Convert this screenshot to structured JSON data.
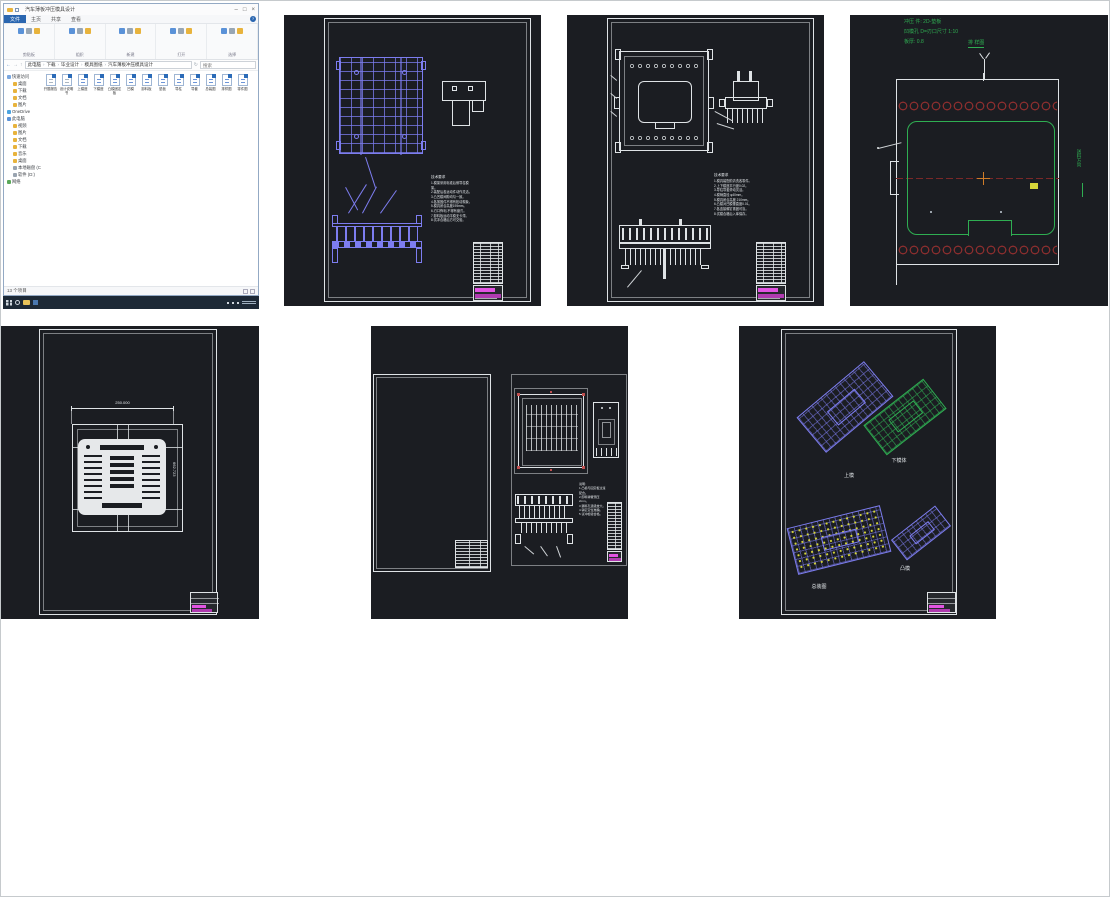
{
  "colors": {
    "cad_background": "#1b1d22",
    "cad_white": "#dfe3e6",
    "cad_purple": "#7d7df0",
    "cad_green": "#2fae52",
    "cad_red": "#8c2e2e",
    "cad_magenta": "#e254e2",
    "cad_yellow": "#d6d63a",
    "cad_orange": "#cf7c28",
    "taskbar_dark": "#1d2936",
    "file_tab_blue": "#2a66b0"
  },
  "explorer": {
    "title": "汽车薄板冲压模具设计",
    "window_controls": {
      "min": "–",
      "max": "□",
      "close": "×"
    },
    "file_tab": "文件",
    "tabs": [
      "主页",
      "共享",
      "查看"
    ],
    "help": "?",
    "groups": [
      {
        "label": "剪贴板"
      },
      {
        "label": "组织"
      },
      {
        "label": "新建"
      },
      {
        "label": "打开"
      },
      {
        "label": "选择"
      }
    ],
    "breadcrumb": [
      "此电脑",
      "下载",
      "毕业设计",
      "模具图纸",
      "汽车薄板冲压模具设计"
    ],
    "search_placeholder": "搜索",
    "nav": [
      {
        "label": "快速访问",
        "indent": 0,
        "icon": "star"
      },
      {
        "label": "桌面",
        "indent": 1,
        "icon": "folder"
      },
      {
        "label": "下载",
        "indent": 1,
        "icon": "folder"
      },
      {
        "label": "文档",
        "indent": 1,
        "icon": "folder"
      },
      {
        "label": "图片",
        "indent": 1,
        "icon": "folder"
      },
      {
        "label": "OneDrive",
        "indent": 0,
        "icon": "cloud"
      },
      {
        "label": "此电脑",
        "indent": 0,
        "icon": "pc"
      },
      {
        "label": "视频",
        "indent": 1,
        "icon": "folder"
      },
      {
        "label": "图片",
        "indent": 1,
        "icon": "folder"
      },
      {
        "label": "文档",
        "indent": 1,
        "icon": "folder"
      },
      {
        "label": "下载",
        "indent": 1,
        "icon": "folder"
      },
      {
        "label": "音乐",
        "indent": 1,
        "icon": "folder"
      },
      {
        "label": "桌面",
        "indent": 1,
        "icon": "folder"
      },
      {
        "label": "本地磁盘 (C:)",
        "indent": 1,
        "icon": "disk"
      },
      {
        "label": "软件 (D:)",
        "indent": 1,
        "icon": "disk"
      },
      {
        "label": "网络",
        "indent": 0,
        "icon": "net"
      }
    ],
    "files": [
      {
        "name": "开题报告",
        "kind": "doc"
      },
      {
        "name": "设计说明书",
        "kind": "doc"
      },
      {
        "name": "上模座",
        "kind": "dwg"
      },
      {
        "name": "下模座",
        "kind": "dwg"
      },
      {
        "name": "凸模固定板",
        "kind": "dwg"
      },
      {
        "name": "凹模",
        "kind": "dwg"
      },
      {
        "name": "卸料板",
        "kind": "dwg"
      },
      {
        "name": "垫板",
        "kind": "dwg"
      },
      {
        "name": "导柱",
        "kind": "dwg"
      },
      {
        "name": "导套",
        "kind": "dwg"
      },
      {
        "name": "总装图",
        "kind": "dwg"
      },
      {
        "name": "排样图",
        "kind": "dwg"
      },
      {
        "name": "零件图",
        "kind": "dwg"
      }
    ],
    "status": "13 个项目"
  },
  "drawings": {
    "sheet_a": {
      "notes_title": "技术要求",
      "notes": [
        "1.模架采用标准后侧导柱模架。",
        "2.装配后各运动件动作灵活。",
        "3.凸凹模间隙均匀一致。",
        "4.各紧固件不得有松动现象。",
        "5.模具闭合高度195mm。",
        "6.刃口锋利,不得有崩刃。",
        "7.卸料板运动平稳无卡滞。",
        "8.试冲合格后方可交验。"
      ]
    },
    "sheet_b": {
      "notes_title": "技术要求",
      "notes": [
        "1.模具装配前清洗各零件。",
        "2.上下模座平行度0.02。",
        "3.导柱导套滑动灵活。",
        "4.模柄直径 φ40mm。",
        "5.模具闭合高度 210mm。",
        "6.凸模对凹模垂直度0.01。",
        "7.各连接螺钉紧固可靠。",
        "8.试模合格后入库保存。"
      ]
    },
    "sheet_c": {
      "line1": "冲压 件: 2D-垫板",
      "line2": "凹模孔 D=刃口尺寸 1:10",
      "line3": "板厚: 0.8",
      "view_label": "排 样图",
      "side_label": "送料方向"
    },
    "sheet_d": {
      "dim_top": "250.000",
      "dim_right": "662.723"
    },
    "sheet_e": {
      "notes": [
        "说明:",
        "1.凸模与固定板过渡配合。",
        "2.卸料弹簧预压2mm。",
        "3.漏料孔逐级放大。",
        "4.销钉定位准确。",
        "5.试冲检验合格。"
      ]
    },
    "sheet_f": {
      "labels": [
        "上模",
        "下模体",
        "总装图",
        "凸模"
      ]
    }
  }
}
